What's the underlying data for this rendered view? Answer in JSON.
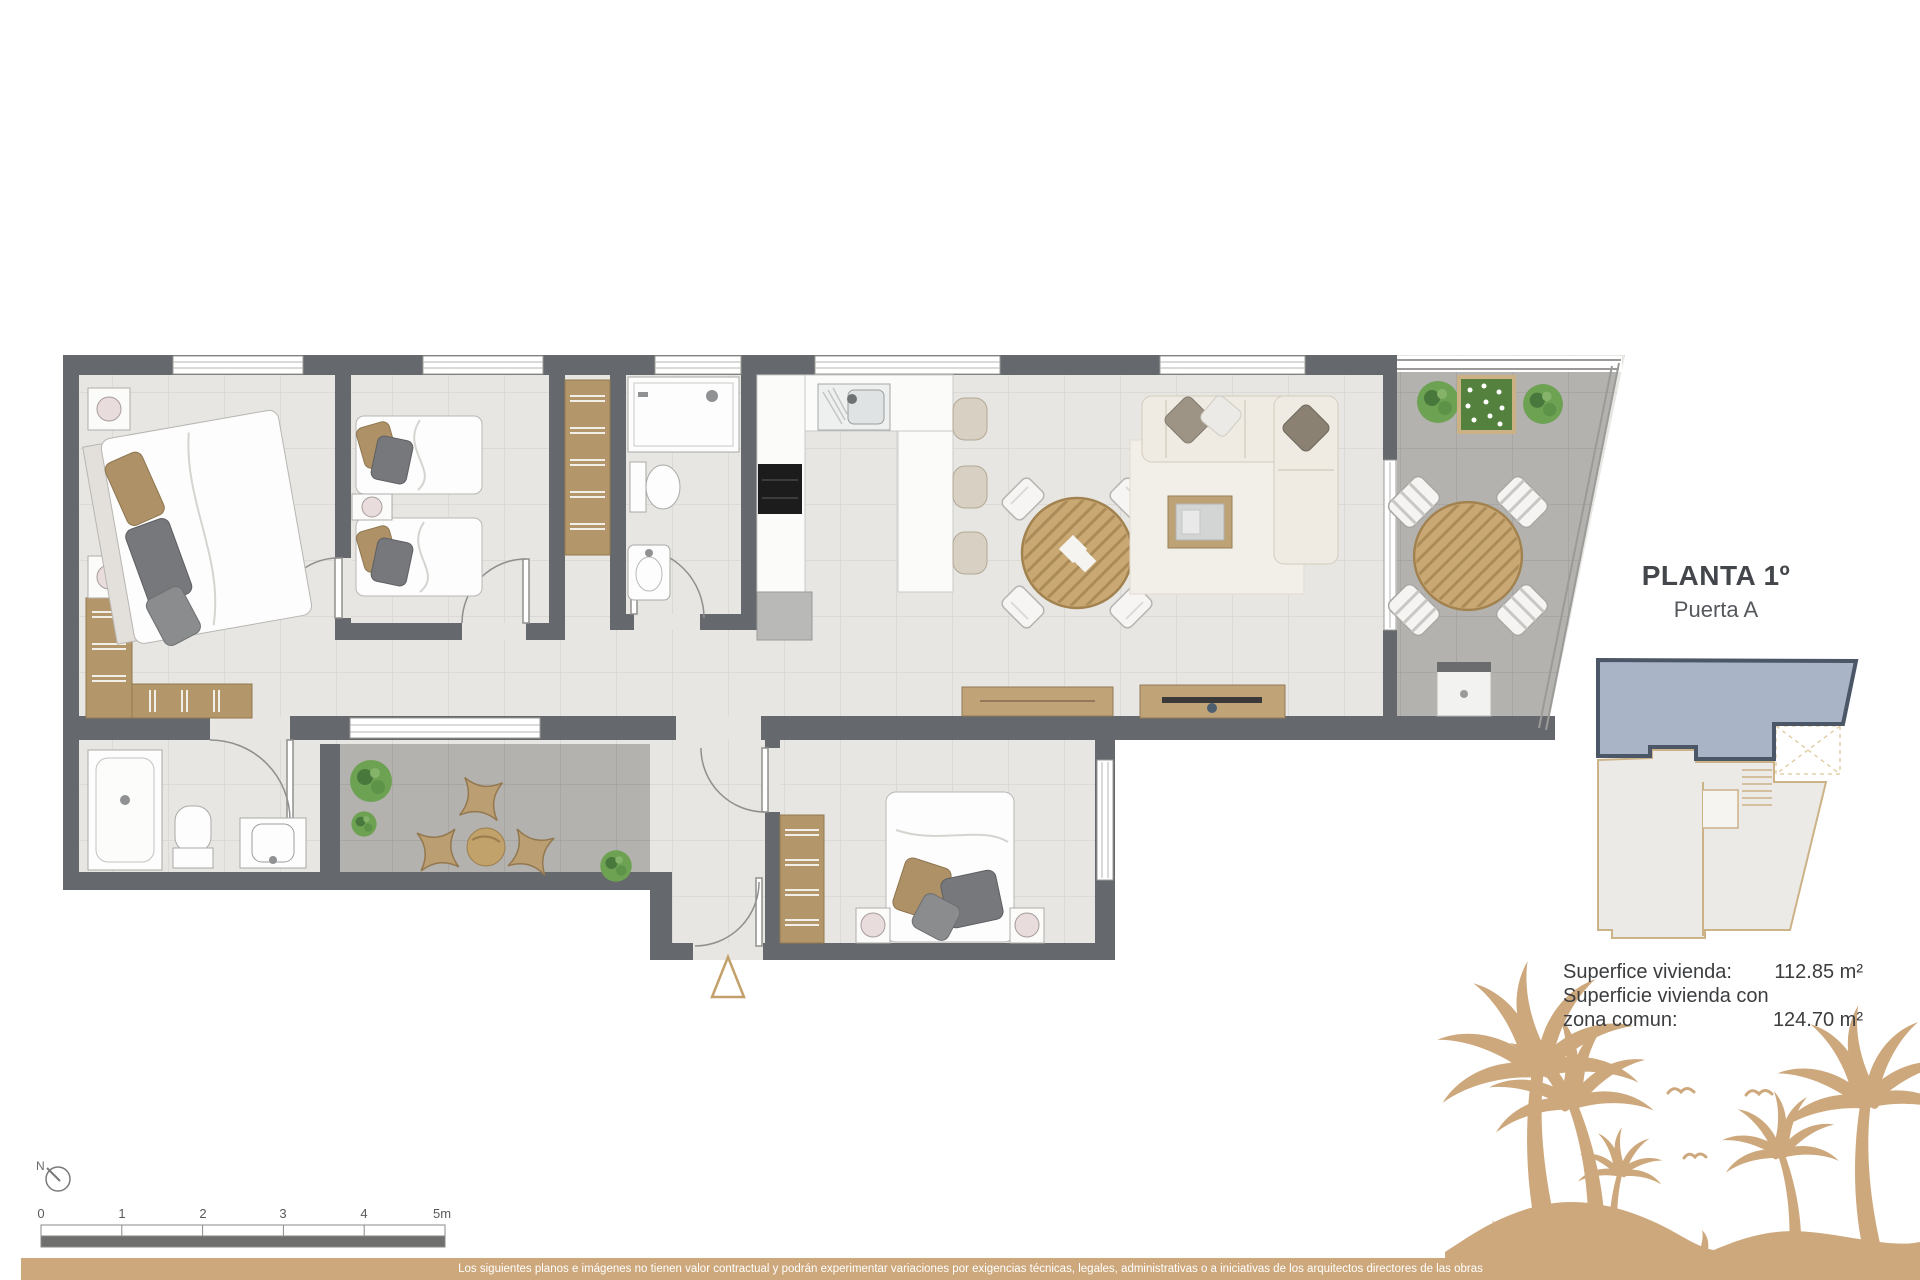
{
  "title": {
    "plan": "PLANTA 1º",
    "door": "Puerta A"
  },
  "area_info": {
    "rows": [
      {
        "label": "Superfice vivienda:",
        "value": "112.85 m²"
      },
      {
        "label": "Superficie vivienda con",
        "value": ""
      },
      {
        "label": "zona comun:",
        "value": "124.70 m²"
      }
    ]
  },
  "scale_bar": {
    "labels": [
      "0",
      "1",
      "2",
      "3",
      "4",
      "5m"
    ]
  },
  "compass": {
    "label": "N"
  },
  "footer": {
    "disclaimer": "Los siguientes planos e imágenes no tienen valor contractual y podrán experimentar variaciones por exigencias técnicas, legales, administrativas o a iniciativas de los arquitectos directores de las obras"
  },
  "colors": {
    "accent_tan": "#cda87c",
    "wall_gray": "#65686c",
    "unit_highlight_blue": "#a9b4c6",
    "tile_light": "#e7e6e3",
    "tile_dark": "#b4b2ae",
    "wood_tan": "#c0a478",
    "plant_green": "#6da253"
  }
}
